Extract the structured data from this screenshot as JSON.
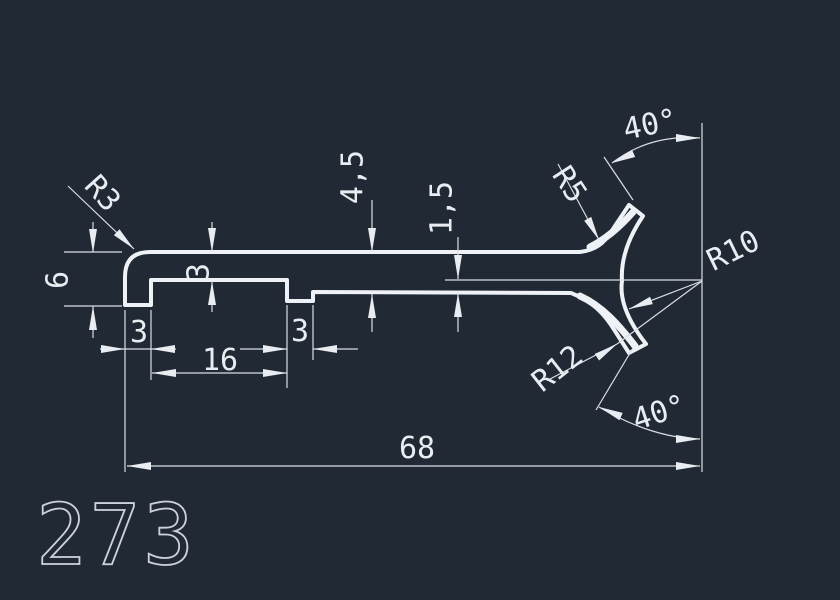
{
  "drawing": {
    "part_number": "273",
    "labels": {
      "overall_width": "68",
      "slot_width": "16",
      "leg_width": "3",
      "notch_width": "3",
      "strip_thickness": "3",
      "leg_height": "6",
      "right_thickness": "4,5",
      "step_height": "1,5",
      "radius_top_left": "R3",
      "radius_upper_fillet": "R5",
      "radius_mouth": "R10",
      "radius_lower_fillet": "R12",
      "angle_top": "40°",
      "angle_bottom": "40°"
    },
    "colors": {
      "background": "#212934",
      "profile_line": "#eef1f5",
      "dimension_line": "#d9dee5",
      "dimension_text": "#e9ecf1",
      "part_number_text": "#ccd2da"
    }
  }
}
